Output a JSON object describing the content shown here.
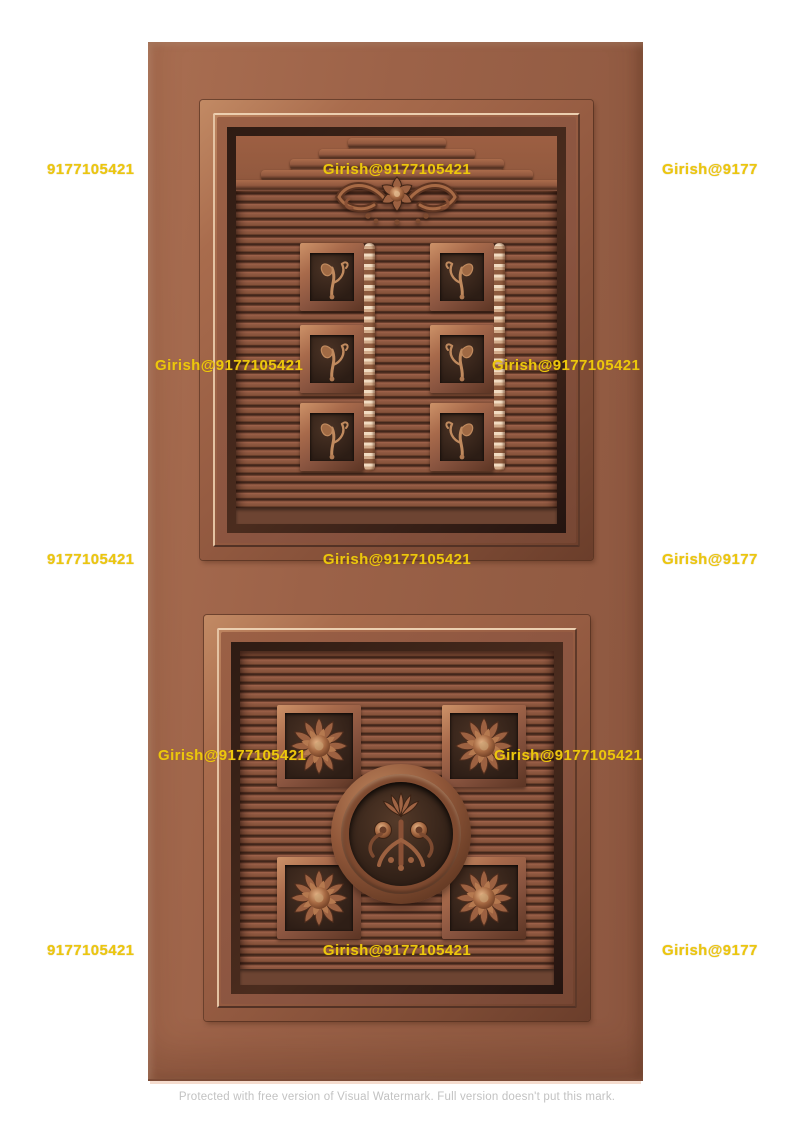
{
  "subject": "3D render of a carved copper-brown two-panel wooden door",
  "colors": {
    "background": "#ffffff",
    "door_base": "#9a6148",
    "panel_louver": "#8a5740",
    "carving_dark": "#2e1e16",
    "molding_highlight": "#eccfb0",
    "watermark_yellow": "#ecc70d",
    "footer_gray": "#c2c2c2"
  },
  "watermarks": {
    "phone": "9177105421",
    "full": "Girish@9177105421",
    "short": "Girish@9177"
  },
  "footer": {
    "text": "Protected with free version of Visual Watermark. Full version doesn't put this mark."
  }
}
